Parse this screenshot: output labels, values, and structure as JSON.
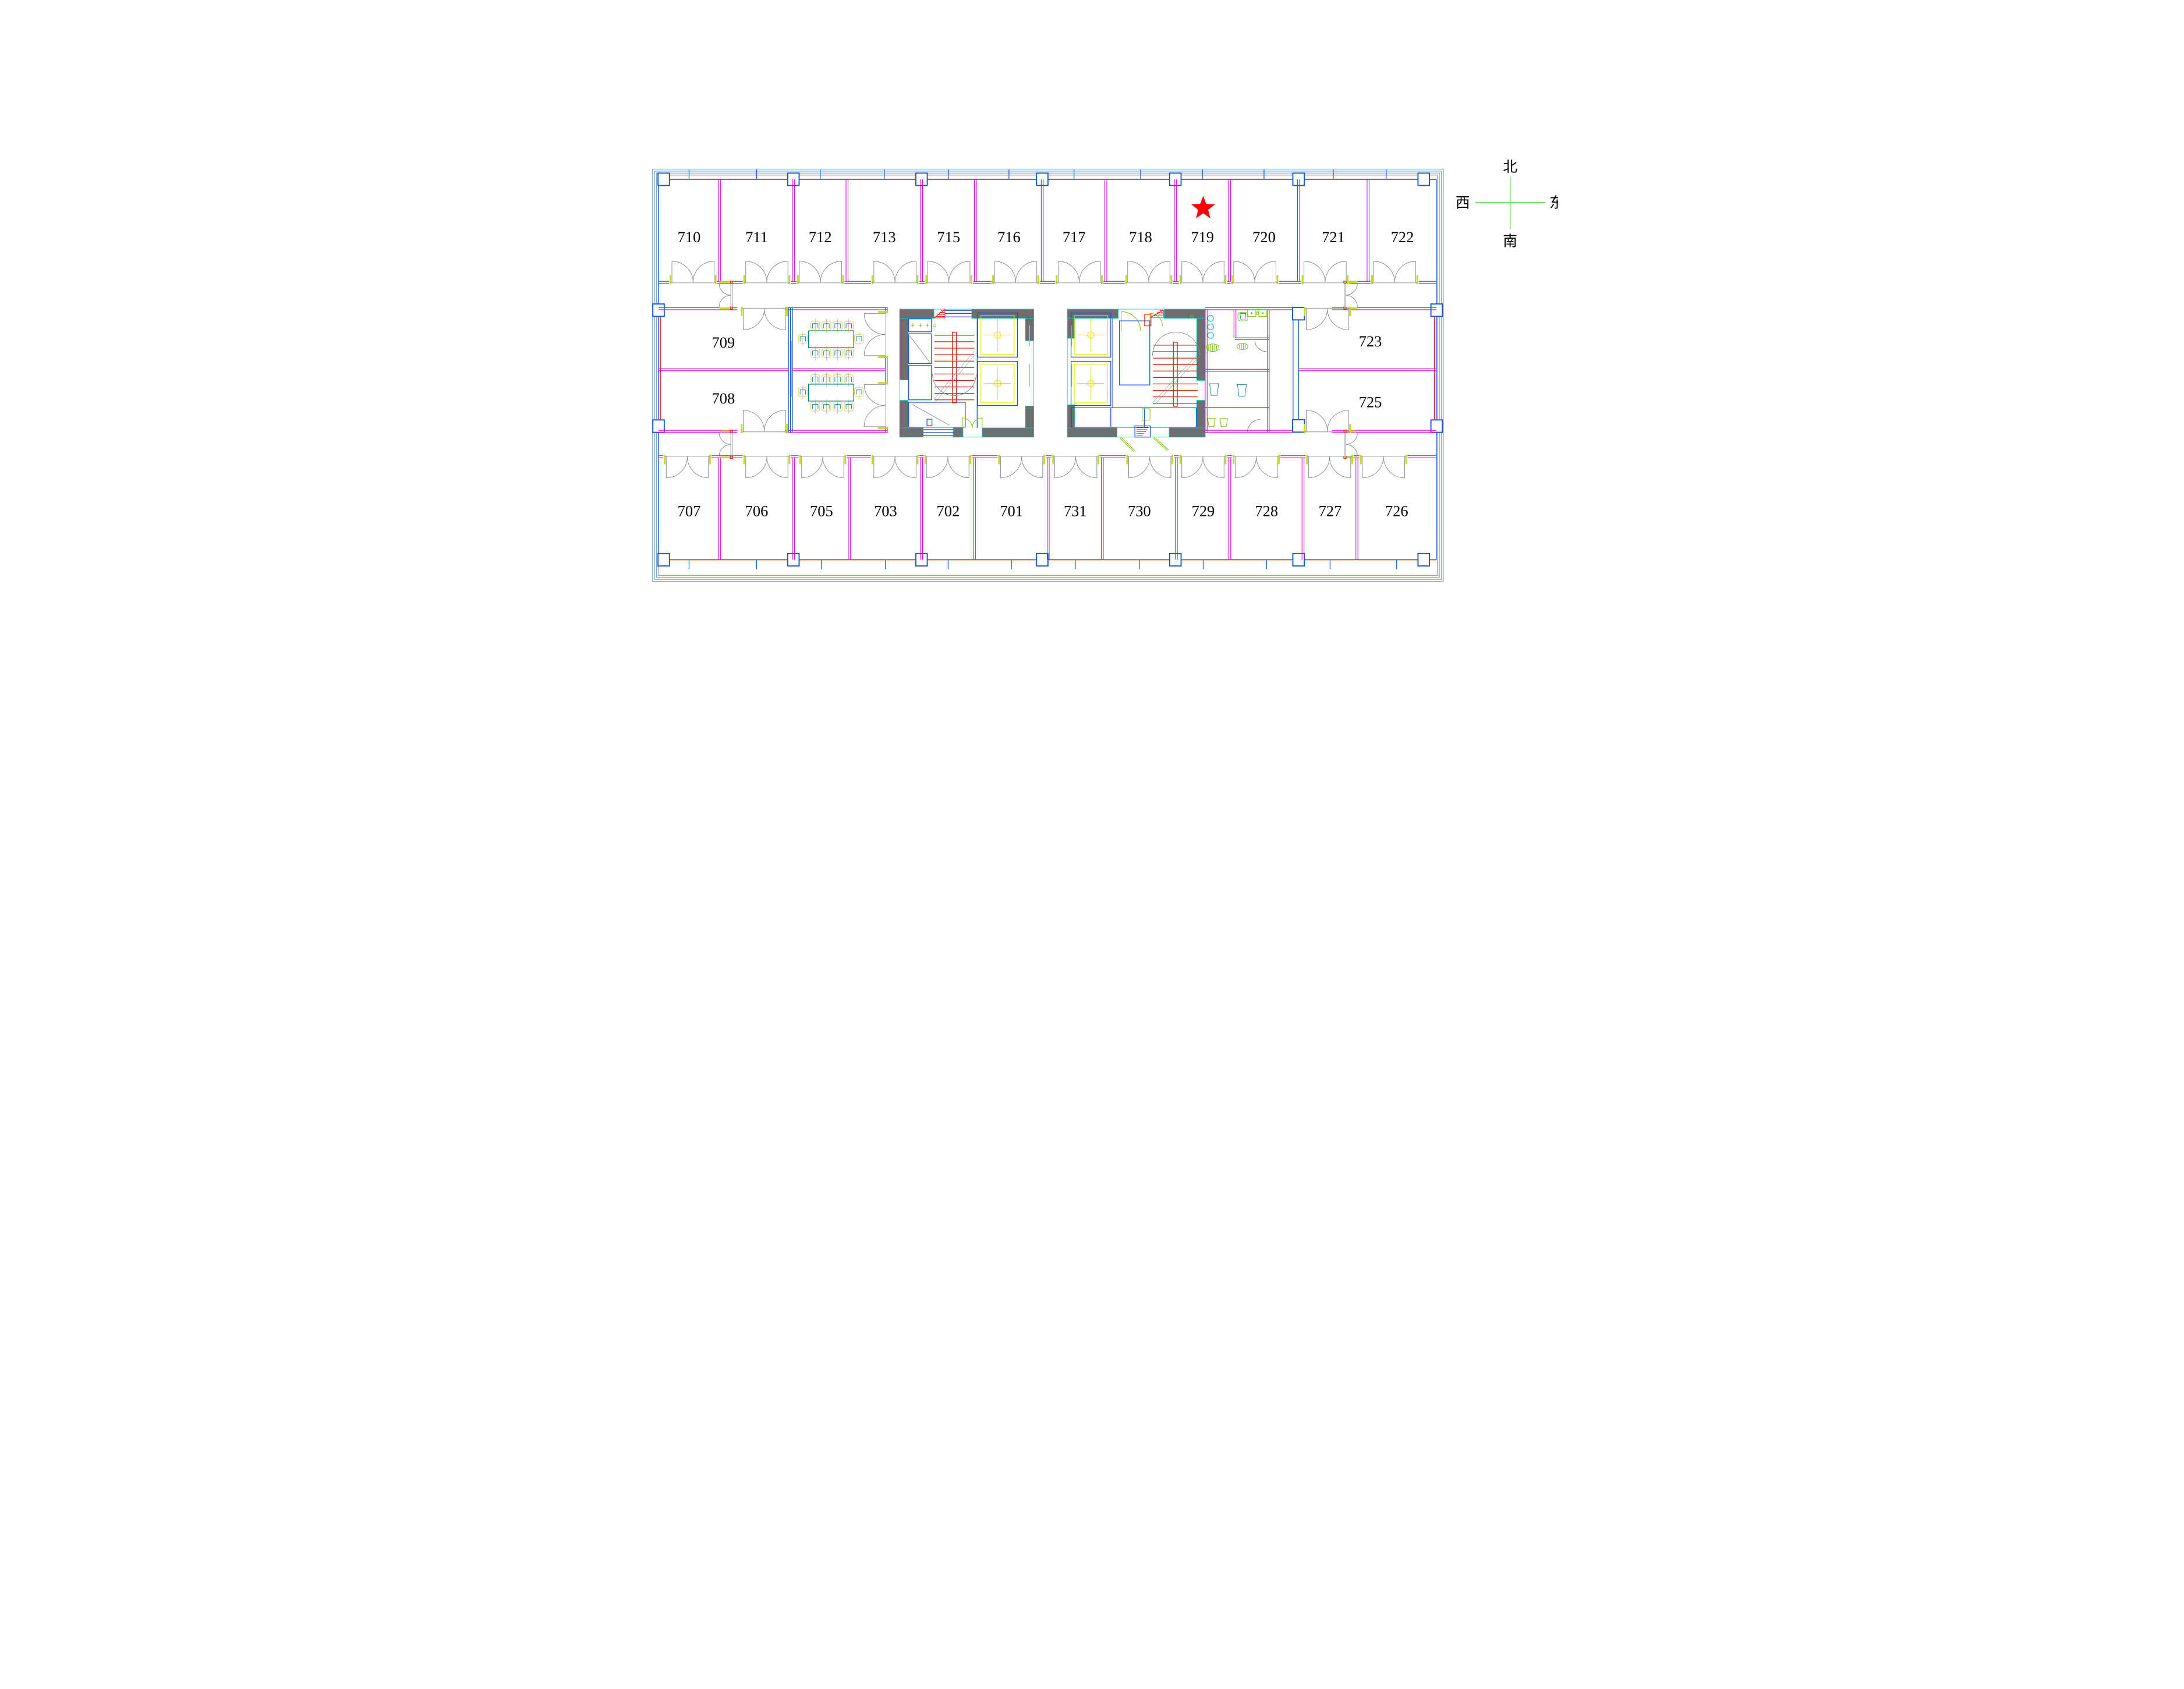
{
  "drawing": {
    "type": "floor-plan",
    "floor": "7F office tower plate"
  },
  "rooms": {
    "top": [
      "710",
      "711",
      "712",
      "713",
      "715",
      "716",
      "717",
      "718",
      "719",
      "720",
      "721",
      "722"
    ],
    "bottom": [
      "707",
      "706",
      "705",
      "703",
      "702",
      "701",
      "731",
      "730",
      "729",
      "728",
      "727",
      "726"
    ],
    "middle_left": [
      "709",
      "708"
    ],
    "middle_right": [
      "723",
      "725"
    ]
  },
  "marker": {
    "shape": "star",
    "room": "719",
    "color": "#ff0000"
  },
  "compass": {
    "north": "北",
    "south": "南",
    "west": "西",
    "east": "东"
  },
  "colors": {
    "exterior_wall": "#e60000",
    "partition_wall": "#dd00dd",
    "column": "#1a53d6",
    "frame": "#8ba3d6",
    "core_wall": "#6e6e6e",
    "core_edge": "#00d0d0",
    "stair": "#cc2414",
    "elevator": "#e6e600",
    "door_jamb": "#c6dc28",
    "door_swing": "#8a8a8a",
    "furniture": "#008080",
    "fixtures_green": "#7dc421",
    "fixtures_cyan": "#00b4d8",
    "compass_cross": "#00c800"
  }
}
